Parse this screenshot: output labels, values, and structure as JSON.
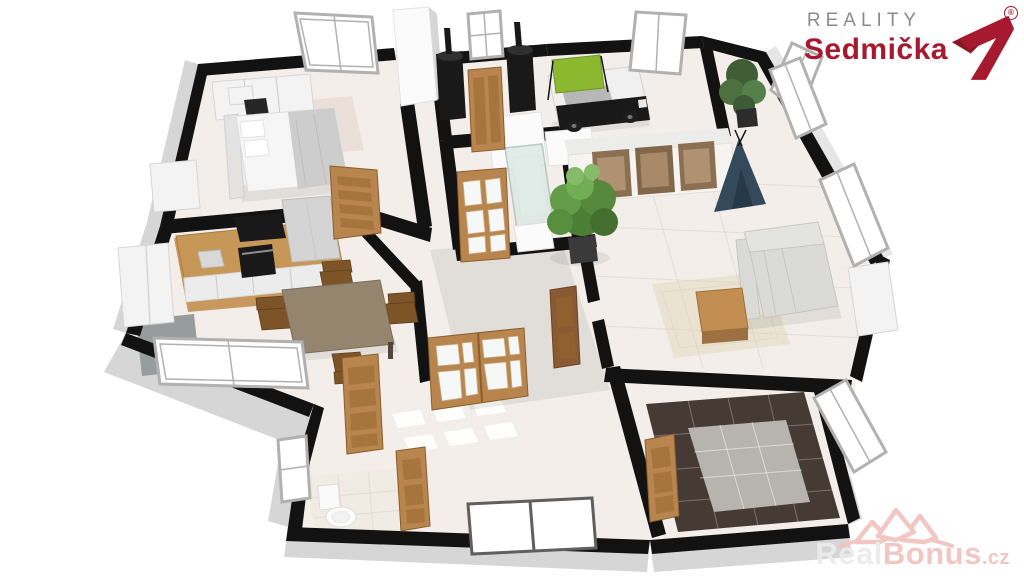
{
  "branding": {
    "line1": "REALITY",
    "line2": "Sedmička",
    "registered": "®"
  },
  "watermark": {
    "part1": "Real",
    "part2": "Bonus",
    "suffix": ".cz"
  },
  "scene": {
    "type": "3d-floor-plan-render",
    "rooms": [
      "bedroom",
      "kitchen-dining",
      "utility-room",
      "shower-bathroom",
      "kids-room",
      "living-room",
      "hallway",
      "wc",
      "dark-tiled-room"
    ]
  },
  "colors": {
    "background": "#ffffff",
    "wall_black": "#121212",
    "wall_face_gray": "#d6d6d6",
    "wall_face_light": "#e6e6e6",
    "wall_white": "#fbfbfb",
    "floor_main": "#f3eeea",
    "floor_wood": "#c9985f",
    "floor_pantry": "#979c9c",
    "floor_wc": "#f0ece4",
    "floor_dark_tile": "#453b34",
    "floor_gray_tile": "#b7b3af",
    "rug_bedroom": "#eadfd9",
    "rug_living": "#eae3d2",
    "door_wood": "#b9854e",
    "door_wood_dark": "#96672f",
    "window_frame": "#b1b1b1",
    "furniture_white": "#f3f3f3",
    "appliance_black": "#191919",
    "table_wood": "#95856e",
    "chair_wood": "#7c5428",
    "sofa": "#dadbd6",
    "car_bed_green": "#8cb82f",
    "teepee_navy": "#34495a",
    "shower_glass": "#d8e7e2",
    "brand_gray": "#8b8b8b",
    "brand_red": "#a6192e",
    "watermark_pink": "#f2c4bf",
    "watermark_light": "#ececec"
  }
}
